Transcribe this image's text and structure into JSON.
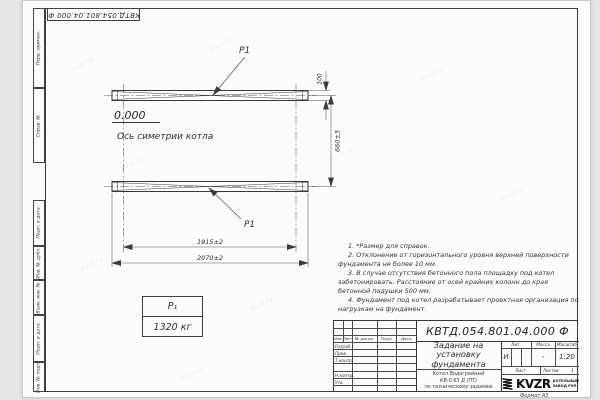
{
  "page": {
    "format_label": "Формат А3",
    "watermark": "kvzr.ru"
  },
  "margin": {
    "top_designation": "КВТД.054.801.04.000 Ф",
    "stamps_top": [
      "Перв. примен.",
      "Справ. №"
    ],
    "stamps_bottom": [
      "Подп. и дата",
      "Инв. № дубл.",
      "Взам. инв. №",
      "Подп. и дата",
      "Инв. № подл."
    ]
  },
  "drawing": {
    "p1_top": "P1",
    "p1_bottom": "P1",
    "elevation": "0.000",
    "axis_caption": "Ось симетрии котла",
    "dim_beam_width": "100",
    "dim_beam_spacing": "660±3",
    "dim_axes": "1915±2",
    "dim_overall": "2070±2"
  },
  "load_table": {
    "symbol": "Р₁",
    "value": "1320 кг"
  },
  "notes": [
    "1. *Размер для справок.",
    "2. Отклонение от горизонтального уровня верхней поверхности фундамента не более 10 мм.",
    "3. В случае отсутствия бетонного пола площадку под котел забетонировать. Расстояние от осей крайних колонн до края бетонной подушки 500 мм.",
    "4. Фундамент под котел разрабатывает проектная организация по нагрузкам на фундамент."
  ],
  "title_block": {
    "designation": "КВТД.054.801.04.000  Ф",
    "title_line1": "Задание на",
    "title_line2": "установку",
    "title_line3": "фундамента",
    "subtitle_line1": "Котел Водогрейный",
    "subtitle_line2": "КВ-0.63 Д (ПТ)",
    "subtitle_line3": "по техническому заданию",
    "col_izm": "Изм.",
    "col_list": "Лист",
    "col_doc": "№ докум.",
    "col_sign": "Подп.",
    "col_date": "Дата",
    "row_razrab": "Разраб.",
    "row_prov": "Пров.",
    "row_tkontr": "Т.контр.",
    "row_nkontr": "Н.контр.",
    "row_utv": "Утв.",
    "lit_header": "Лит.",
    "mass_header": "Масса",
    "scale_header": "Масштаб",
    "lit_value": "И",
    "mass_value": "-",
    "scale_value": "1:20",
    "sheet_label": "Лист",
    "sheets_label": "Листов",
    "sheets_value": "1",
    "logo_text": "KVZR",
    "logo_caption_line1": "КОТЕЛЬНЫЙ",
    "logo_caption_line2": "ЗАВОД РЭП"
  }
}
